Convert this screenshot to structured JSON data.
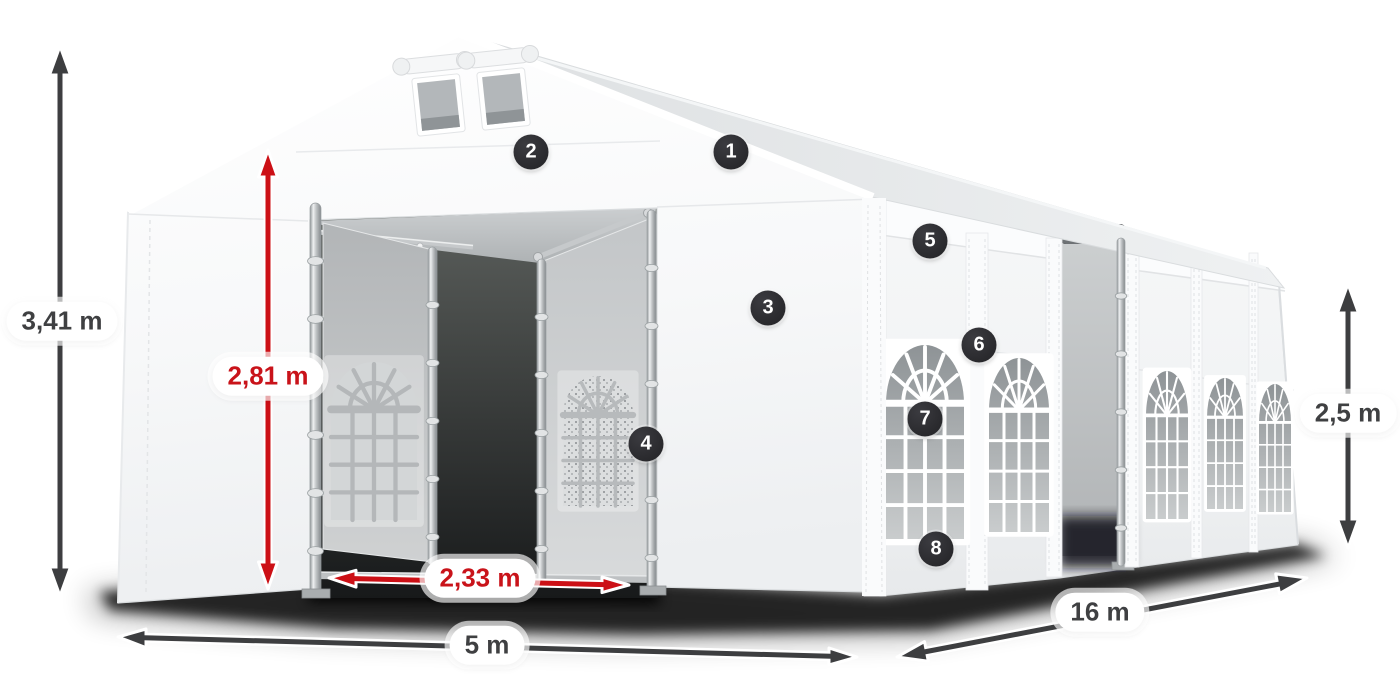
{
  "dimensions": [
    {
      "id": "total-height",
      "value": "3,41 m",
      "style": "dark",
      "color": "#3f4042",
      "orientation": "vertical"
    },
    {
      "id": "entrance-height",
      "value": "2,81 m",
      "style": "red",
      "color": "#c9131a",
      "orientation": "vertical"
    },
    {
      "id": "entrance-width",
      "value": "2,33 m",
      "style": "red",
      "color": "#c9131a",
      "orientation": "horizontal"
    },
    {
      "id": "tent-width",
      "value": "5 m",
      "style": "dark",
      "color": "#3f4042",
      "orientation": "horizontal"
    },
    {
      "id": "tent-length",
      "value": "16 m",
      "style": "dark",
      "color": "#3f4042",
      "orientation": "diagonal"
    },
    {
      "id": "side-height",
      "value": "2,5 m",
      "style": "dark",
      "color": "#3f4042",
      "orientation": "vertical"
    }
  ],
  "callouts": [
    {
      "number": "1"
    },
    {
      "number": "2"
    },
    {
      "number": "3"
    },
    {
      "number": "4"
    },
    {
      "number": "5"
    },
    {
      "number": "6"
    },
    {
      "number": "7"
    },
    {
      "number": "8"
    }
  ],
  "colors": {
    "accent_red": "#c9131a",
    "dimension_dark": "#3f4042",
    "badge_background": "#26262a",
    "badge_text": "#ffffff",
    "tent_white": "#f6f7f8",
    "window_pane_gray": "#9aa0a3",
    "shadow": "#000000"
  }
}
